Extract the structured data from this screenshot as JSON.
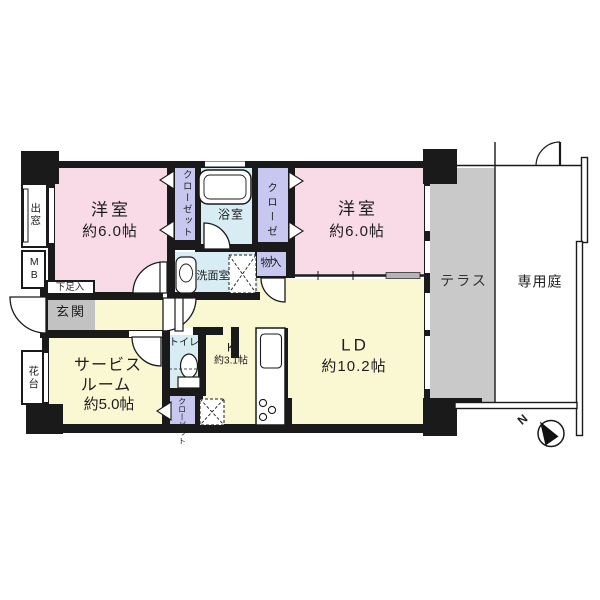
{
  "colors": {
    "wall": "#1a1a1a",
    "bedroom_pink": "#f8dbe6",
    "closet_purple": "#c7c7ef",
    "wet_blue": "#d8edf3",
    "ldk_yellow": "#faf8d2",
    "entrance_gray": "#c2c2c2",
    "terrace_gray": "#c9c9c9"
  },
  "rooms": {
    "bedroom1": {
      "label": "洋室",
      "area": "約6.0帖"
    },
    "bedroom2": {
      "label": "洋室",
      "area": "約6.0帖"
    },
    "living_dining": {
      "label": "LD",
      "area": "約10.2帖"
    },
    "kitchen": {
      "label": "K",
      "area": "約3.1帖"
    },
    "service_room": {
      "label1": "サービス",
      "label2": "ルーム",
      "area": "約5.0帖"
    },
    "bathroom": {
      "label": "浴室"
    },
    "washroom": {
      "label": "洗面室"
    },
    "toilet": {
      "label": "トイレ"
    },
    "entrance": {
      "label": "玄関"
    },
    "terrace": {
      "label": "テラス"
    },
    "garden": {
      "label": "専用庭"
    }
  },
  "fixtures": {
    "closet": "クローゼット",
    "storage": "物入",
    "shoe_cabinet": "下足入",
    "meter_box": "MB",
    "bay_window": "出窓",
    "flower_stand": "花台",
    "compass_north": "N"
  }
}
